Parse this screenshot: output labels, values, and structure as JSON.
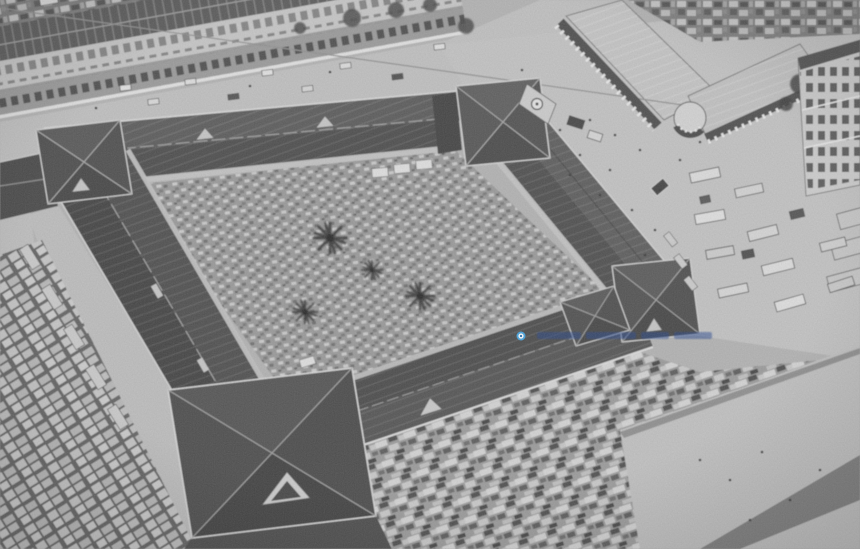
{
  "meta": {
    "description": "Black-and-white aerial photograph of a large quadrangular covered market (Ben Thanh Market style): four long dark hip-roofed wings enclosing a stall-filled courtyard with trees, a clock-gable gate pavilion at the top, corner pavilions, surrounding streets with shophouse rows, a colonial corner building, parked buses and dense market stalls."
  },
  "watermark": {
    "text": "",
    "dot_outer_color": "#3fa3e2",
    "dot_inner_color": "#ffffff",
    "dot_core_color": "#1565ad",
    "text_color": "#1e3f8e"
  },
  "palette": {
    "ground": "#b4b4b4",
    "street_light": "#c2c2c2",
    "plaza_light": "#c5c5c5",
    "plaza_bottom": "#c3c3c3",
    "roof_dark": "#3e3e3e",
    "roof_mid": "#4a4a4a",
    "roof_face_light": "#575757",
    "courtyard_base": "#9c9c9c",
    "awning_light": "#c6c6c6",
    "eave_highlight": "#dcdcdc",
    "stall_base": "#9e9e9e",
    "vehicle_light": "#e0e0e0",
    "shadow_band": "#6e6e6e"
  }
}
